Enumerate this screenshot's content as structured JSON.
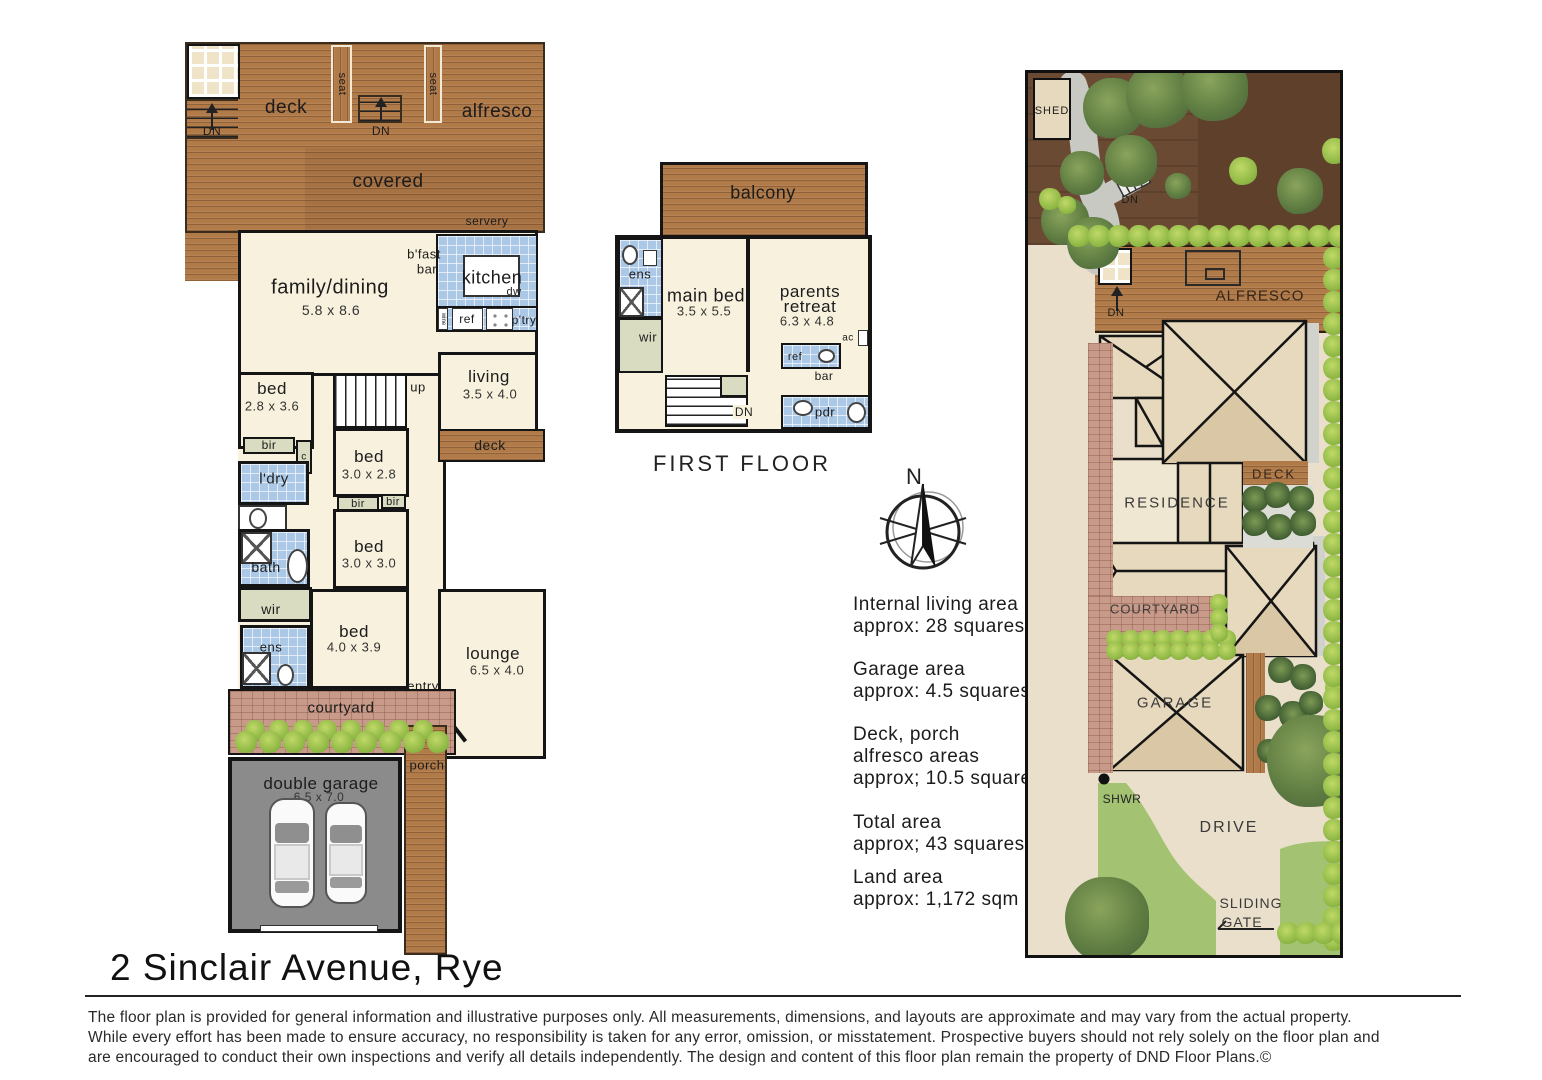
{
  "common": {
    "dn": "DN",
    "up": "up"
  },
  "ground": {
    "deck": "deck",
    "alfresco": "alfresco",
    "covered": "covered",
    "servery": "servery",
    "seat": "seat",
    "family": {
      "label": "family/dining",
      "dims": "5.8 x 8.6"
    },
    "kitchen": {
      "label": "kitchen",
      "dw": "dw",
      "bfast1": "b'fast",
      "bfast2": "bar",
      "wine": "wine",
      "ref": "ref",
      "ptry": "p'try"
    },
    "living": {
      "label": "living",
      "dims": "3.5 x 4.0"
    },
    "bed1": {
      "label": "bed",
      "dims": "2.8 x 3.6"
    },
    "bed2": {
      "label": "bed",
      "dims": "3.0 x 2.8"
    },
    "bed3": {
      "label": "bed",
      "dims": "3.0 x 3.0"
    },
    "bed4": {
      "label": "bed",
      "dims": "4.0 x 3.9"
    },
    "bir": "bir",
    "c": "c",
    "ldry": "l'dry",
    "bath": "bath",
    "wir": "wir",
    "ens": "ens",
    "deck2": "deck",
    "courtyard": "courtyard",
    "entry": "entry",
    "lounge": {
      "label": "lounge",
      "dims": "6.5 x 4.0"
    },
    "porch": "porch",
    "garage": {
      "label": "double garage",
      "dims": "6.5 x 7.0"
    }
  },
  "first": {
    "balcony": "balcony",
    "ens": "ens",
    "wir": "wir",
    "main_bed": {
      "label": "main bed",
      "dims": "3.5 x 5.5"
    },
    "parents": {
      "l1": "parents",
      "l2": "retreat",
      "dims": "6.3 x 4.8"
    },
    "ac": "ac",
    "ref": "ref",
    "bar": "bar",
    "pdr": "pdr",
    "title": "FIRST FLOOR"
  },
  "compass": {
    "n": "N"
  },
  "stats": {
    "g1l1": "Internal living area",
    "g1l2": "approx: 28 squares",
    "g2l1": "Garage area",
    "g2l2": "approx: 4.5 squares",
    "g3l1": "Deck, porch",
    "g3l2": "alfresco areas",
    "g3l3": "approx; 10.5  squares",
    "g4l1": "Total area",
    "g4l2": "approx;  43 squares",
    "g5l1": "Land area",
    "g5l2": "approx: 1,172 sqm"
  },
  "site": {
    "shed": "SHED",
    "alfresco": "ALFRESCO",
    "deck": "DECK",
    "residence": "RESIDENCE",
    "courtyard": "COURTYARD",
    "garage": "GARAGE",
    "shwr": "SHWR",
    "drive": "DRIVE",
    "gate1": "SLIDING",
    "gate2": "GATE"
  },
  "footer": {
    "address": "2 Sinclair Avenue, Rye",
    "disclaimer1": "The floor plan is provided for general information and illustrative purposes only. All measurements, dimensions, and layouts are approximate and may vary from the actual property.",
    "disclaimer2": "While every effort has been made to ensure accuracy, no responsibility is taken for any error, omission, or misstatement. Prospective buyers should not rely solely on the floor plan and",
    "disclaimer3": "are encouraged to conduct their own inspections and verify all details independently. The design and content of this floor plan remain the property of DND Floor Plans.©"
  },
  "palette": {
    "wood": "#b07a49",
    "wet_tile": "#abc9e7",
    "robe": "#d9dcc1",
    "brick": "#c89a89",
    "garage_floor": "#8b8b8b",
    "soil": "#6b4a33",
    "lawn": "#a3c272",
    "hedge": "#8fb845",
    "roof": "#e7d9bd",
    "site_bg": "#e9dfcb"
  }
}
